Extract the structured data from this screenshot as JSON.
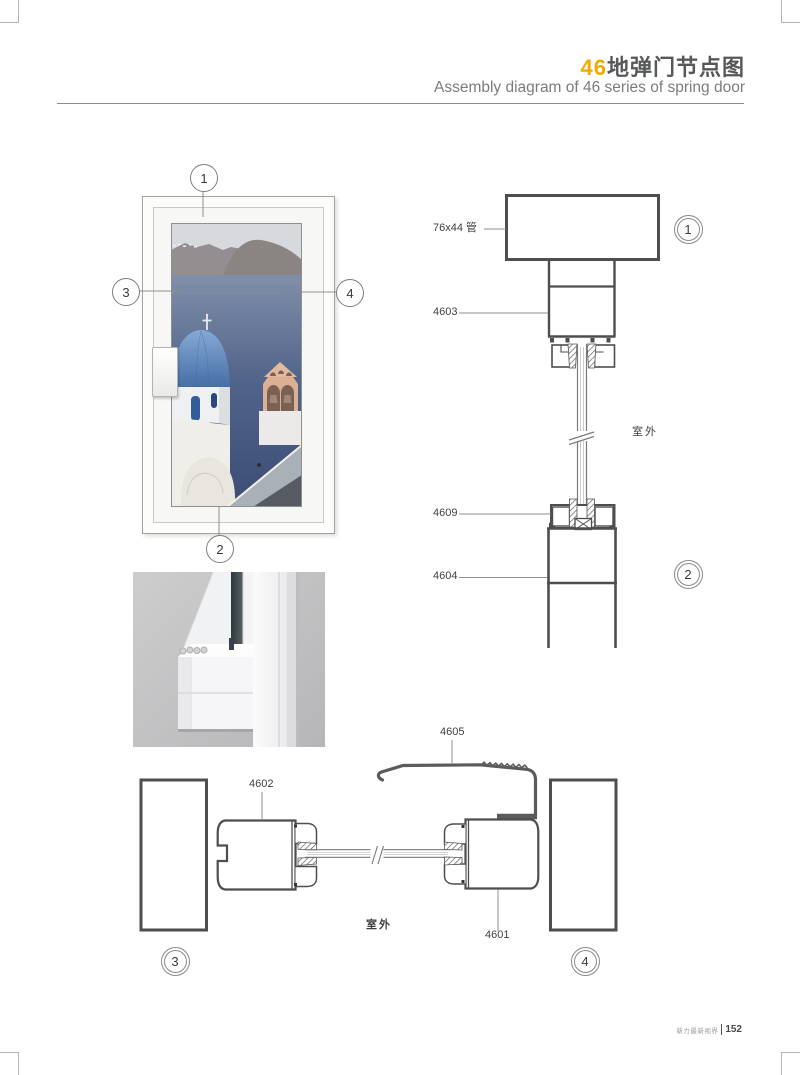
{
  "header": {
    "title_accent": "46",
    "title": "地弹门节点图",
    "subtitle": "Assembly diagram of 46 series of spring door"
  },
  "door": {
    "callout_top": "1",
    "callout_bottom": "2",
    "callout_left": "3",
    "callout_right": "4"
  },
  "top_section": {
    "tube_label": "76x44 管",
    "profile_4603": "4603",
    "outdoor": "室外",
    "profile_4609": "4609",
    "profile_4604": "4604",
    "callout_top": "1",
    "callout_bottom": "2"
  },
  "bottom_section": {
    "profile_4605": "4605",
    "profile_4602": "4602",
    "profile_4601": "4601",
    "outdoor": "室外",
    "callout_left": "3",
    "callout_right": "4"
  },
  "footer": {
    "brand": "新力最新视界",
    "page": "152"
  },
  "colors": {
    "accent": "#F2A900",
    "line": "#4e4e4e",
    "strip": "#5b5b5b"
  }
}
